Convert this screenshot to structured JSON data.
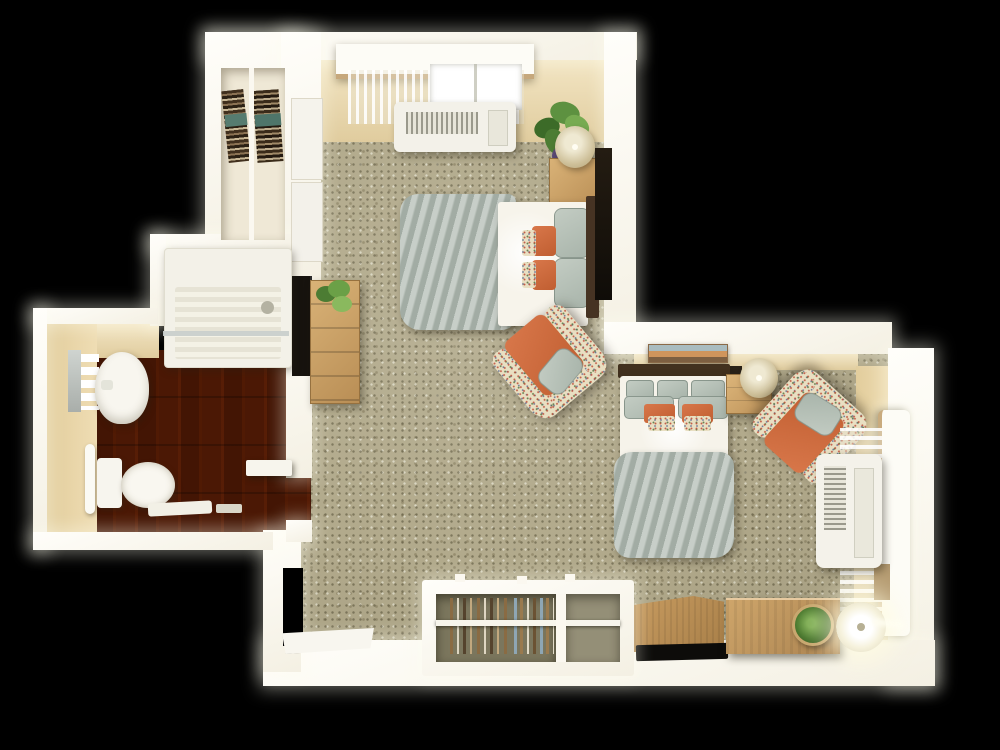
{
  "meta": {
    "type": "3d-floorplan-render",
    "description": "Top-down 3D rendering of a studio apartment floor plan on a black background, with a carpeted sleeping/living L-shaped space, a hardwood bathroom at left, two beds with sage and orange bedding, two floral armchairs, closets and windows with PTAC air-conditioning units",
    "width_px": 1000,
    "height_px": 750
  },
  "colors": {
    "background": "#000000",
    "wall_white": "#fcfaf2",
    "wall_face_cream": "#e9d8b0",
    "carpet": "#b2aa8c",
    "wood_floor": "#8a4e22",
    "furniture_wood": "#c69d66",
    "bedding_sage": "#b7c0b8",
    "bedding_white": "#f6f3ea",
    "pillow_orange": "#ce6a3a",
    "floral_fabric": "#e9dfc2",
    "plant_green": "#5d9140",
    "lamp_shade": "#d8cba6",
    "tv_black": "#16130e",
    "headboard_brown": "#42311f",
    "closet_interior": "#7b765d",
    "teal_linen": "#567c70"
  },
  "scene": {
    "style": "photoreal dollhouse cutaway view, bright glowing white walls",
    "rooms": [
      {
        "id": "bedroom",
        "label": "Sleeping area (top)",
        "floor": "speckled beige carpet",
        "furniture": [
          "linen closet with stacks of folded brown and teal towels",
          "double closet doors on left wall",
          "window with white cornice and sheer curtains",
          "PTAC air-conditioning unit under window",
          "bed with white sheets, sage folded comforter, sage pillows, orange accent pillows, floral pillows",
          "dark wood headboard",
          "wood nightstand with drum-shade lamp and leafy potted plant",
          "dark wall panel beside bed",
          "wood dresser with small potted plant",
          "wall-mounted flat TV facing bed"
        ]
      },
      {
        "id": "bathroom",
        "label": "Bathroom (left, hardwood floor)",
        "floor": "brown hardwood planks",
        "furniture": [
          "walk-in shower with ridged tray, glass edge and drain",
          "mirror strip with white toiletry bottles",
          "white pedestal sink",
          "toilet with tank",
          "towel bar on wall",
          "white bath mat and small accessories",
          "open white bathroom door"
        ]
      },
      {
        "id": "living",
        "label": "Living / second sleeping area (right)",
        "floor": "speckled beige carpet",
        "furniture": [
          "landscape artwork on wall",
          "second bed with white duvet, sage pillows, orange accent pillows, floral pillows, sage foot comforter",
          "dark wood headboard",
          "wood nightstand with drum-shade lamp",
          "two floral armchairs with orange cushions and sage throw pillows",
          "window with white cornice, sheer curtains and tan drape",
          "PTAC air-conditioning unit under window",
          "wood media chest with flat TV",
          "wood desk with round potted plant",
          "glowing white floor lamp",
          "built-in wardrobe with hanging clothes and shelf",
          "open white entry door"
        ]
      }
    ]
  }
}
